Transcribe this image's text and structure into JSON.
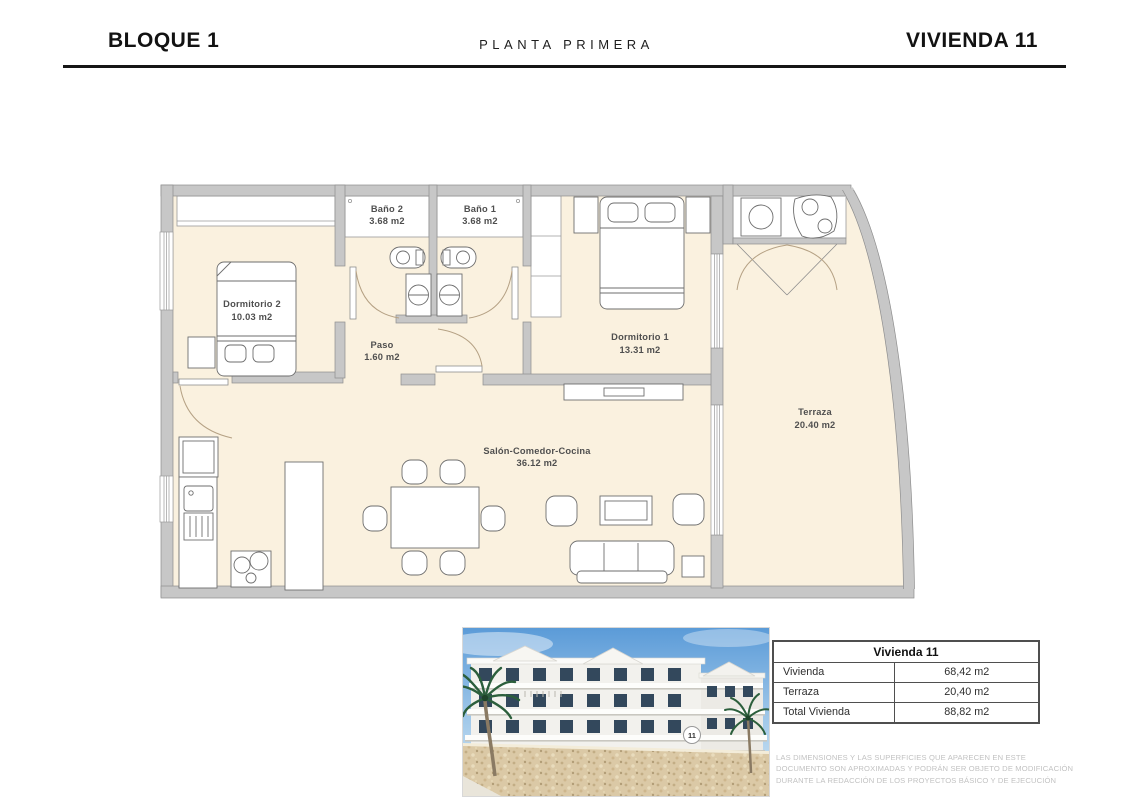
{
  "header": {
    "block": "BLOQUE 1",
    "floor": "PLANTA PRIMERA",
    "unit": "VIVIENDA 11"
  },
  "plan": {
    "rooms": {
      "dormitorio2": {
        "name": "Dormitorio 2",
        "area": "10.03 m2"
      },
      "bano2": {
        "name": "Baño 2",
        "area": "3.68 m2"
      },
      "bano1": {
        "name": "Baño 1",
        "area": "3.68 m2"
      },
      "dormitorio1": {
        "name": "Dormitorio 1",
        "area": "13.31 m2"
      },
      "paso": {
        "name": "Paso",
        "area": "1.60 m2"
      },
      "salon": {
        "name": "Salón-Comedor-Cocina",
        "area": "36.12 m2"
      },
      "terraza": {
        "name": "Terraza",
        "area": "20.40 m2"
      }
    },
    "colors": {
      "floor": "#FAF1DF",
      "wall": "#C7C7C7",
      "wall_stroke": "#8E8E8E",
      "furniture_stroke": "#6E6E6E",
      "door_arc": "#B5A184",
      "label": "#4F4F4F"
    }
  },
  "render": {
    "badge": "11"
  },
  "summary_table": {
    "title": "Vivienda 11",
    "rows": [
      {
        "label": "Vivienda",
        "value": "68,42 m2"
      },
      {
        "label": "Terraza",
        "value": "20,40 m2"
      },
      {
        "label": "Total Vivienda",
        "value": "88,82 m2"
      }
    ]
  },
  "disclaimer": "LAS DIMENSIONES Y LAS SUPERFICIES QUE APARECEN EN ESTE DOCUMENTO SON APROXIMADAS Y PODRÁN SER OBJETO DE MODIFICACIÓN DURANTE LA REDACCIÓN DE LOS PROYECTOS BÁSICO Y DE EJECUCIÓN"
}
